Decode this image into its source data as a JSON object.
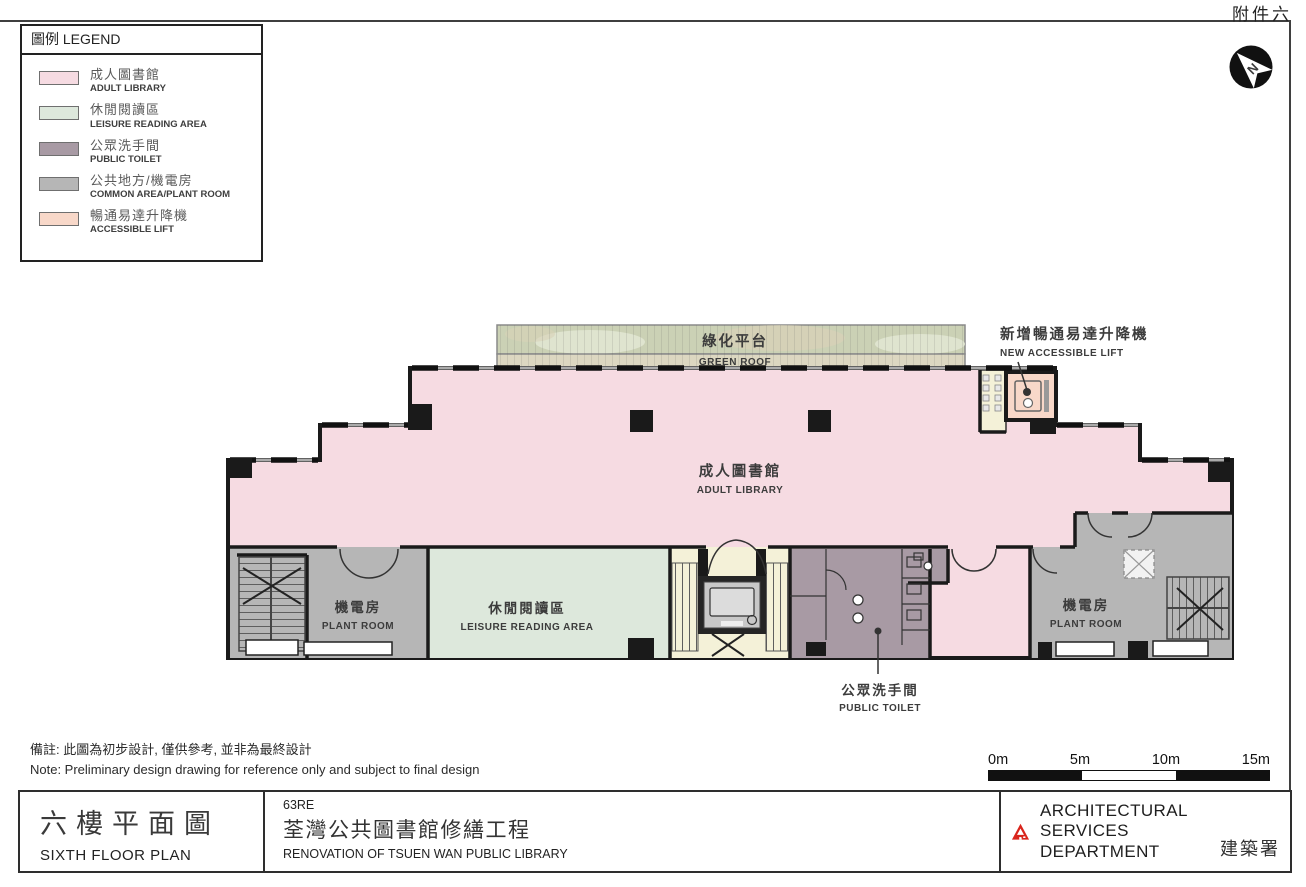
{
  "page": {
    "appendix": "附件六"
  },
  "colors": {
    "pink": "#f6dbe2",
    "green": "#dde8dc",
    "mauve": "#a89aa4",
    "gray": "#b6b6b6",
    "peach": "#f8d8c9",
    "cream": "#f4f1d8",
    "rooftop": "#cbd1b5",
    "roofbot": "#dcd7c1",
    "wall": "#1a1a1a",
    "red": "#d9251c",
    "ink": "#3c3c3c"
  },
  "legend": {
    "title": "圖例 LEGEND",
    "items": [
      {
        "zh": "成人圖書館",
        "en": "ADULT LIBRARY"
      },
      {
        "zh": "休閒閱讀區",
        "en": "LEISURE READING AREA"
      },
      {
        "zh": "公眾洗手間",
        "en": "PUBLIC TOILET"
      },
      {
        "zh": "公共地方/機電房",
        "en": "COMMON AREA/PLANT ROOM"
      },
      {
        "zh": "暢通易達升降機",
        "en": "ACCESSIBLE LIFT"
      }
    ]
  },
  "plan": {
    "north": "N",
    "green_roof": {
      "zh": "綠化平台",
      "en": "GREEN ROOF"
    },
    "new_lift": {
      "zh": "新增暢通易達升降機",
      "en": "NEW ACCESSIBLE LIFT"
    },
    "adult_library": {
      "zh": "成人圖書館",
      "en": "ADULT LIBRARY"
    },
    "plant_room_left": {
      "zh": "機電房",
      "en": "PLANT ROOM"
    },
    "leisure": {
      "zh": "休閒閱讀區",
      "en": "LEISURE READING AREA"
    },
    "plant_room_right": {
      "zh": "機電房",
      "en": "PLANT ROOM"
    },
    "public_toilet": {
      "zh": "公眾洗手間",
      "en": "PUBLIC TOILET"
    }
  },
  "note": {
    "line1": "備註: 此圖為初步設計, 僅供參考, 並非為最終設計",
    "line2": "Note: Preliminary design drawing for reference only and subject to final design"
  },
  "scale_bar": {
    "ticks": [
      "0m",
      "5m",
      "10m",
      "15m"
    ]
  },
  "title_block": {
    "floor_zh": "六樓平面圖",
    "floor_en": "SIXTH FLOOR PLAN",
    "code": "63RE",
    "project_zh": "荃灣公共圖書館修繕工程",
    "project_en": "RENOVATION OF TSUEN WAN PUBLIC LIBRARY",
    "dept_en": "ARCHITECTURAL SERVICES DEPARTMENT",
    "dept_zh": "建築署"
  }
}
